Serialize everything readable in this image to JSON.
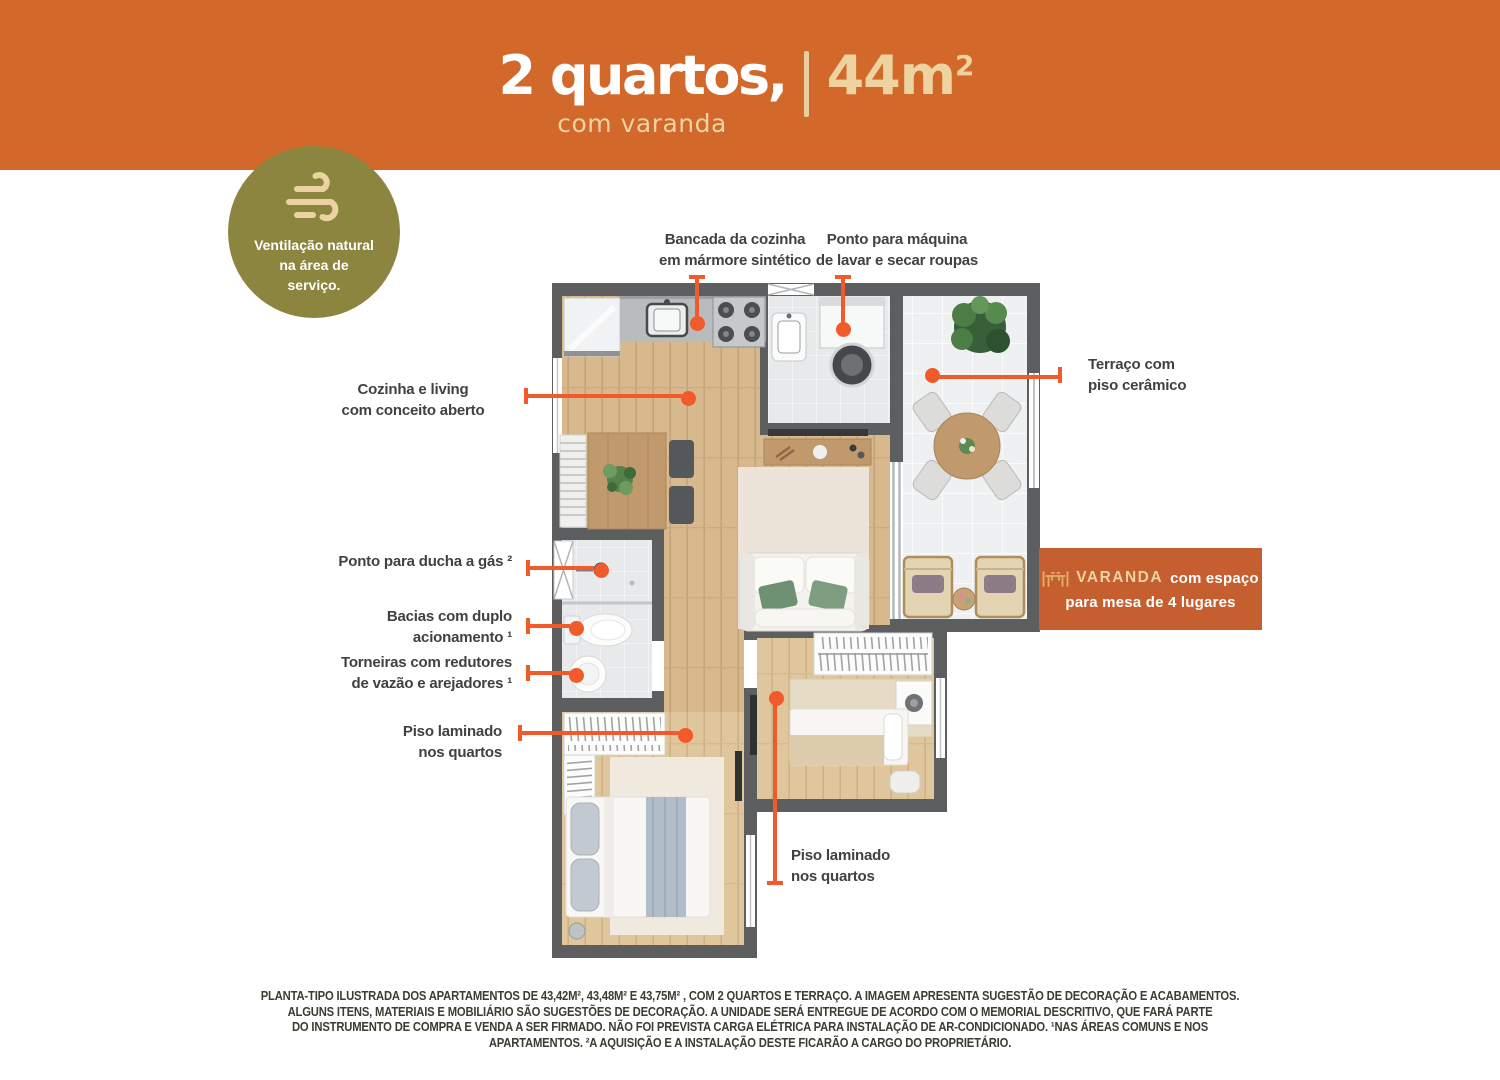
{
  "header": {
    "title": "2 quartos,",
    "subtitle": "com varanda",
    "area_value": "44m",
    "area_sup": "2"
  },
  "badge": {
    "icon": "wind-icon",
    "text": "Ventilação natural\nna área de\nserviço."
  },
  "callouts": {
    "bancada": {
      "text": "Bancada da cozinha\nem mármore sintético"
    },
    "maquina": {
      "text": "Ponto para máquina\nde lavar e secar roupas"
    },
    "terraco": {
      "text": "Terraço com\npiso cerâmico"
    },
    "cozinha": {
      "text": "Cozinha e living\ncom conceito aberto"
    },
    "ducha": {
      "text": "Ponto para ducha a gás ²"
    },
    "bacias": {
      "text": "Bacias com duplo\nacionamento ¹"
    },
    "torneiras": {
      "text": "Torneiras com redutores\nde vazão e arejadores ¹"
    },
    "piso_esq": {
      "text": "Piso laminado\nnos quartos"
    },
    "piso_dir": {
      "text": "Piso laminado\nnos quartos"
    }
  },
  "varanda_box": {
    "icon": "table-chairs-icon",
    "highlight": "VARANDA",
    "rest": "com espaço",
    "line2": "para mesa de 4 lugares"
  },
  "footer": {
    "lines": [
      "PLANTA-TIPO ILUSTRADA DOS APARTAMENTOS DE 43,42M², 43,48M² E 43,75M² , COM 2 QUARTOS E TERRAÇO. A IMAGEM APRESENTA SUGESTÃO DE DECORAÇÃO E ACABAMENTOS.",
      "ALGUNS ITENS, MATERIAIS E MOBILIÁRIO SÃO SUGESTÕES DE DECORAÇÃO. A UNIDADE SERÁ ENTREGUE DE ACORDO COM O MEMORIAL DESCRITIVO, QUE FARÁ PARTE",
      "DO INSTRUMENTO DE COMPRA E VENDA A SER FIRMADO. NÃO FOI PREVISTA CARGA ELÉTRICA PARA INSTALAÇÃO DE AR-CONDICIONADO. ¹NAS ÁREAS COMUNS E NOS",
      "APARTAMENTOS. ²A AQUISIÇÃO E A INSTALAÇÃO DESTE FICARÃO A CARGO DO PROPRIETÁRIO."
    ]
  },
  "colors": {
    "header_orange": "#d2682a",
    "cream": "#eed3a1",
    "olive_badge": "#8b853f",
    "leader_orange": "#f15b2b",
    "varanda_box_orange": "#c65f2f",
    "label_gray": "#414042",
    "wall_gray": "#5d5e60"
  }
}
